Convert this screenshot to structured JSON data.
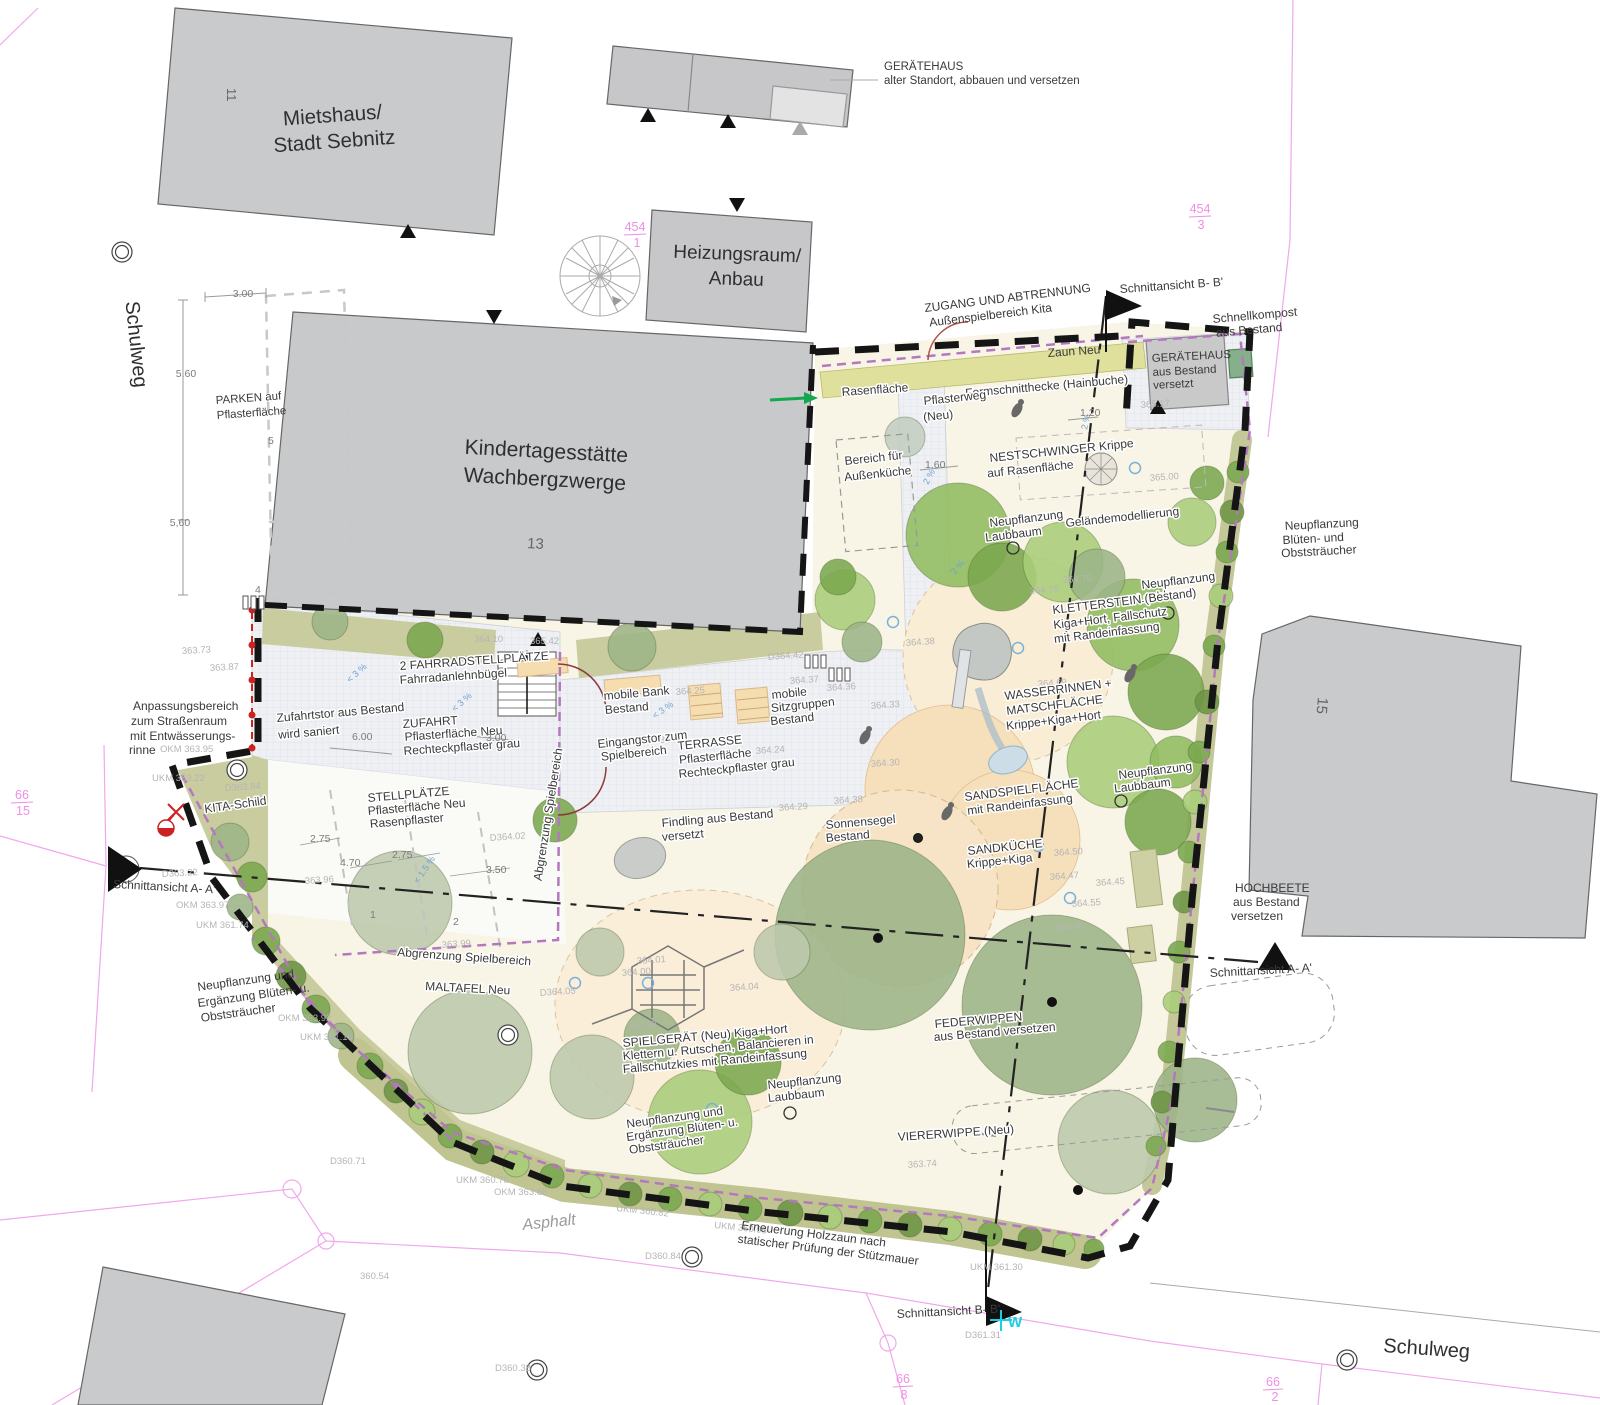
{
  "streets": {
    "schulweg_left": "Schulweg",
    "schulweg_bottom": "Schulweg",
    "asphalt": "Asphalt"
  },
  "parcels": {
    "p454_1_num": "454",
    "p454_1_den": "1",
    "p454_3_num": "454",
    "p454_3_den": "3",
    "p66_15_num": "66",
    "p66_15_den": "15",
    "p66_8_num": "66",
    "p66_8_den": "8",
    "p66_2_num": "66",
    "p66_2_den": "2"
  },
  "buildings": {
    "mietshaus_l1": "Mietshaus/",
    "mietshaus_l2": "Stadt Sebnitz",
    "mietshaus_no": "11",
    "heizung_l1": "Heizungsraum/",
    "heizung_l2": "Anbau",
    "kita_l1": "Kindertagesstätte",
    "kita_l2": "Wachbergzwerge",
    "kita_no": "13",
    "b15_no": "15"
  },
  "annotations": {
    "ger_alt_l1": "GERÄTEHAUS",
    "ger_alt_l2": "alter Standort, abbauen und versetzen",
    "schnitt_bb": "Schnittansicht B- B'",
    "schnitt_aa": "Schnittansicht A- A'",
    "zugang_l1": "ZUGANG UND ABTRENNUNG",
    "zugang_l2": "Außenspielbereich Kita",
    "zaun_neu": "Zaun Neu",
    "kompost_l1": "Schnellkompost",
    "kompost_l2": "aus Bestand",
    "ger_neu_l1": "GERÄTEHAUS",
    "ger_neu_l2": "aus Bestand",
    "ger_neu_l3": "versetzt",
    "hecke": "Formschnitthecke (Hainbuche)",
    "rasen": "Rasenfläche",
    "pweg_l1": "Pflasterweg",
    "pweg_l2": "(Neu)",
    "kueche_l1": "Bereich für",
    "kueche_l2": "Außenküche",
    "nest_l1": "NESTSCHWINGER Krippe",
    "nest_l2": "auf Rasenfläche",
    "gelaende": "Geländemodellierung",
    "npl_l1": "Neupflanzung",
    "npl_l2": "Laubbaum",
    "np_obst_r_l1": "Neupflanzung",
    "np_obst_r_l2": "Blüten- und",
    "np_obst_r_l3": "Obststräucher",
    "klst_l1": "KLETTERSTEIN (Bestand)",
    "klst_l2": "Kiga+Hort, Fallschutz",
    "klst_l3": "mit Randeinfassung",
    "wass_l1": "WASSERRINNEN +",
    "wass_l2": "MATSCHFLÄCHE",
    "wass_l3": "Krippe+Kiga+Hort",
    "sandsp_l1": "SANDSPIELFLÄCHE",
    "sandsp_l2": "mit Randeinfassung",
    "sandk_l1": "SANDKÜCHE",
    "sandk_l2": "Krippe+Kiga",
    "hochb_l1": "HOCHBEETE",
    "hochb_l2": "aus Bestand",
    "hochb_l3": "versetzen",
    "anp_l1": "Anpassungsbereich",
    "anp_l2": "zum Straßenraum",
    "anp_l3": "mit Entwässerungs-",
    "anp_l4": "rinne",
    "parken_l1": "PARKEN auf",
    "parken_l2": "Pflasterfläche",
    "rad_l1": "2 FAHRRADSTELLPLÄTZE",
    "rad_l2": "Fahrradanlehnbügel",
    "tor_l1": "Zufahrtstor aus Bestand",
    "tor_l2": "wird saniert",
    "zufahrt_l1": "ZUFAHRT",
    "zufahrt_l2": "Pflasterfläche Neu",
    "zufahrt_l3": "Rechteckpflaster grau",
    "kita_schild": "KITA-Schild",
    "stell_l1": "STELLPLÄTZE",
    "stell_l2": "Pflasterfläche Neu",
    "stell_l3": "Rasenpflaster",
    "bank_l1": "mobile Bank",
    "bank_l2": "Bestand",
    "sitz_l1": "mobile",
    "sitz_l2": "Sitzgruppen",
    "sitz_l3": "Bestand",
    "eing_l1": "Eingangstor zum",
    "eing_l2": "Spielbereich",
    "terr_l1": "TERRASSE",
    "terr_l2": "Pflasterfläche",
    "terr_l3": "Rechteckpflaster grau",
    "abgr": "Abgrenzung Spielbereich",
    "findling_l1": "Findling aus Bestand",
    "findling_l2": "versetzt",
    "sonnen_l1": "Sonnensegel",
    "sonnen_l2": "Bestand",
    "maltafel": "MALTAFEL Neu",
    "np_erg_l1": "Neupflanzung und",
    "np_erg_l2": "Ergänzung Blüten- u.",
    "np_erg_l3": "Obststräucher",
    "spielg_l1": "SPIELGERÄT (Neu) Kiga+Hort",
    "spielg_l2": "Klettern u. Rutschen, Balancieren in",
    "spielg_l3": "Fallschutzkies mit Randeinfassung",
    "feder_l1": "FEDERWIPPEN",
    "feder_l2": "aus Bestand versetzen",
    "vierer": "VIERERWIPPE (Neu)",
    "holz_l1": "Erneuerung Holzzaun nach",
    "holz_l2": "statischer Prüfung der Stützmauer",
    "w_mark": "W"
  },
  "dimensions": {
    "d300_top": "3.00",
    "d560a": "5.60",
    "d560b": "5,60",
    "d600": "6.00",
    "d300_zufahrt": "3.00",
    "d275a": "2.75",
    "d470": "4.70",
    "d275b": "2.75",
    "d350": "3.50",
    "d160": "1.60",
    "d120": "1.20",
    "n5": "5",
    "n4": "4",
    "n1": "1",
    "n2": "2"
  },
  "colors": {
    "building": "#c8c9ca",
    "cream": "#f9f5e6",
    "hedge": "#dfe09b",
    "olive": "#c9cc9e",
    "fence": "#151515",
    "abgrenzung": "#b478be",
    "parcel_line": "#f0a8ec",
    "sand": "#f6e0bc",
    "compost": "#86b08c",
    "red": "#cc2222",
    "cyan": "#19cfe0",
    "green_arrow": "#12a94d"
  },
  "site": {
    "tree_palette": [
      "#8fbc60",
      "#a9cd7a",
      "#7aa74e",
      "#9cb488",
      "#bcc8ac",
      "#c3cdc0",
      "#6d9446"
    ],
    "trees": [
      [
        845,
        600,
        30,
        1
      ],
      [
        862,
        642,
        20,
        3
      ],
      [
        958,
        535,
        52,
        0
      ],
      [
        1002,
        577,
        34,
        2
      ],
      [
        1063,
        562,
        40,
        1
      ],
      [
        1133,
        625,
        46,
        0
      ],
      [
        1166,
        692,
        38,
        2
      ],
      [
        1097,
        577,
        28,
        3
      ],
      [
        1113,
        762,
        46,
        1
      ],
      [
        1158,
        822,
        33,
        2
      ],
      [
        1176,
        762,
        26,
        0
      ],
      [
        905,
        437,
        20,
        5
      ],
      [
        632,
        647,
        24,
        3
      ],
      [
        425,
        640,
        18,
        2
      ],
      [
        330,
        622,
        18,
        3
      ],
      [
        870,
        935,
        95,
        3
      ],
      [
        1052,
        1005,
        90,
        3
      ],
      [
        1195,
        1100,
        42,
        3
      ],
      [
        400,
        903,
        52,
        4
      ],
      [
        470,
        1052,
        62,
        4
      ],
      [
        592,
        1077,
        42,
        4
      ],
      [
        652,
        1037,
        28,
        3
      ],
      [
        700,
        1122,
        52,
        1
      ],
      [
        748,
        1062,
        33,
        2
      ],
      [
        1110,
        1142,
        52,
        4
      ],
      [
        600,
        952,
        24,
        4
      ],
      [
        782,
        952,
        28,
        4
      ],
      [
        1192,
        522,
        24,
        1
      ],
      [
        1207,
        483,
        17,
        2
      ],
      [
        838,
        577,
        18,
        2
      ],
      [
        555,
        820,
        22,
        2
      ],
      [
        230,
        842,
        19,
        3
      ],
      [
        252,
        877,
        15,
        2
      ],
      [
        240,
        907,
        13,
        3
      ],
      [
        266,
        941,
        14,
        2
      ],
      [
        291,
        976,
        15,
        6
      ],
      [
        316,
        1009,
        14,
        2
      ],
      [
        341,
        1036,
        13,
        3
      ],
      [
        370,
        1066,
        13,
        2
      ],
      [
        396,
        1091,
        12,
        6
      ],
      [
        422,
        1112,
        13,
        1
      ],
      [
        450,
        1136,
        12,
        2
      ],
      [
        482,
        1152,
        12,
        6
      ],
      [
        516,
        1164,
        13,
        1
      ],
      [
        552,
        1176,
        12,
        2
      ],
      [
        590,
        1186,
        12,
        1
      ],
      [
        630,
        1194,
        12,
        6
      ],
      [
        670,
        1199,
        12,
        2
      ],
      [
        710,
        1204,
        12,
        1
      ],
      [
        750,
        1209,
        12,
        2
      ],
      [
        790,
        1213,
        13,
        6
      ],
      [
        830,
        1217,
        12,
        1
      ],
      [
        870,
        1221,
        12,
        2
      ],
      [
        910,
        1225,
        12,
        6
      ],
      [
        950,
        1229,
        12,
        1
      ],
      [
        990,
        1234,
        12,
        2
      ],
      [
        1030,
        1239,
        12,
        6
      ],
      [
        1064,
        1244,
        11,
        1
      ],
      [
        1094,
        1249,
        10,
        2
      ],
      [
        1238,
        472,
        11,
        2
      ],
      [
        1232,
        512,
        12,
        6
      ],
      [
        1227,
        552,
        11,
        2
      ],
      [
        1221,
        596,
        12,
        1
      ],
      [
        1214,
        646,
        11,
        2
      ],
      [
        1207,
        702,
        12,
        6
      ],
      [
        1199,
        752,
        11,
        2
      ],
      [
        1195,
        802,
        12,
        1
      ],
      [
        1189,
        852,
        11,
        2
      ],
      [
        1184,
        902,
        11,
        6
      ],
      [
        1179,
        952,
        11,
        2
      ],
      [
        1174,
        1002,
        11,
        1
      ],
      [
        1169,
        1052,
        11,
        2
      ],
      [
        1162,
        1102,
        11,
        6
      ],
      [
        1156,
        1146,
        10,
        2
      ]
    ],
    "trunk_dots": [
      [
        878,
        938
      ],
      [
        1052,
        1002
      ],
      [
        918,
        838
      ],
      [
        1078,
        1190
      ]
    ],
    "new_tree_markers": [
      [
        1013,
        548
      ],
      [
        1168,
        613
      ],
      [
        1121,
        801
      ],
      [
        790,
        1113
      ]
    ],
    "blue_markers": [
      [
        1135,
        468
      ],
      [
        1018,
        648
      ],
      [
        1038,
        846
      ],
      [
        1070,
        898
      ],
      [
        575,
        983
      ],
      [
        648,
        983
      ],
      [
        712,
        1109
      ],
      [
        893,
        622
      ]
    ],
    "manholes": [
      [
        122,
        252
      ],
      [
        237,
        770
      ],
      [
        508,
        1035
      ],
      [
        692,
        1257
      ],
      [
        1347,
        1360
      ],
      [
        537,
        1370
      ]
    ],
    "figures": [
      [
        865,
        737
      ],
      [
        1017,
        410
      ],
      [
        947,
        813
      ],
      [
        1130,
        675
      ]
    ],
    "elevations": [
      [
        530,
        644,
        "365.42",
        0
      ],
      [
        474,
        642,
        "364.10",
        0
      ],
      [
        768,
        660,
        "D364.42",
        -4
      ],
      [
        676,
        695,
        "364.25",
        -4
      ],
      [
        660,
        743,
        "364.11",
        -4
      ],
      [
        756,
        754,
        "364.24",
        -4
      ],
      [
        906,
        646,
        "364.38",
        -4
      ],
      [
        790,
        684,
        "364.37",
        -4
      ],
      [
        827,
        691,
        "364.36",
        -4
      ],
      [
        871,
        709,
        "364.33",
        -4
      ],
      [
        871,
        767,
        "364.30",
        -4
      ],
      [
        834,
        804,
        "364.38",
        -4
      ],
      [
        779,
        811,
        "364.29",
        -4
      ],
      [
        1141,
        408,
        "365.17",
        -4
      ],
      [
        1150,
        481,
        "365.00",
        -4
      ],
      [
        1063,
        583,
        "364.75",
        -4
      ],
      [
        1030,
        594,
        "364.70",
        -4
      ],
      [
        1038,
        687,
        "364.69",
        -4
      ],
      [
        994,
        794,
        "364.56",
        -4
      ],
      [
        1054,
        856,
        "364.50",
        -4
      ],
      [
        1050,
        880,
        "364.47",
        -4
      ],
      [
        1096,
        886,
        "364.45",
        -4
      ],
      [
        1072,
        907,
        "364.55",
        -4
      ],
      [
        1055,
        931,
        "364.36",
        -4
      ],
      [
        908,
        1168,
        "363.74",
        -4
      ],
      [
        622,
        976,
        "364.00",
        -4
      ],
      [
        637,
        964,
        "364.01",
        -4
      ],
      [
        730,
        991,
        "364.04",
        -4
      ],
      [
        628,
        1029,
        "363.93",
        -4
      ],
      [
        540,
        996,
        "D364.05",
        -4
      ],
      [
        490,
        841,
        "D364.02",
        -4
      ],
      [
        442,
        948,
        "363.99",
        -4
      ],
      [
        305,
        884,
        "363.96",
        -4
      ],
      [
        210,
        671,
        "363.87",
        -3
      ],
      [
        182,
        654,
        "363.73",
        -3
      ],
      [
        225,
        791,
        "D363.84",
        -3
      ],
      [
        162,
        877,
        "D363.22",
        -3
      ],
      [
        330,
        1164,
        "D360.71",
        0
      ],
      [
        360,
        1279,
        "360.54",
        0
      ],
      [
        495,
        1371,
        "D360.38",
        0
      ],
      [
        645,
        1259,
        "D360.84",
        0
      ],
      [
        965,
        1338,
        "D361.31",
        0
      ],
      [
        160,
        752,
        "OKM 363.95",
        0
      ],
      [
        152,
        781,
        "UKM 363.22",
        0
      ],
      [
        176,
        908,
        "OKM 363.97",
        0
      ],
      [
        196,
        928,
        "UKM 361.74",
        0
      ],
      [
        278,
        1021,
        "OKM 363.92",
        0
      ],
      [
        300,
        1040,
        "UKM 361.16",
        0
      ],
      [
        616,
        1211,
        "UKM 360.82",
        6
      ],
      [
        714,
        1228,
        "UKM 360.96",
        6
      ],
      [
        970,
        1270,
        "UKM 361.30",
        0
      ],
      [
        456,
        1183,
        "UKM 360.78",
        0
      ],
      [
        494,
        1195,
        "OKM 363.88",
        0
      ]
    ],
    "slopes": [
      [
        1087,
        430,
        "2 %",
        -78
      ],
      [
        928,
        485,
        "2 %",
        -62
      ],
      [
        955,
        575,
        "2 %",
        -50
      ],
      [
        350,
        683,
        "< 3 %",
        -42
      ],
      [
        455,
        712,
        "< 3 %",
        -42
      ],
      [
        655,
        719,
        "< 3 %",
        -35
      ],
      [
        418,
        884,
        "< 1.5 %",
        -55
      ]
    ],
    "bike_racks": [
      [
        243,
        596
      ],
      [
        805,
        655
      ],
      [
        829,
        668
      ]
    ]
  }
}
